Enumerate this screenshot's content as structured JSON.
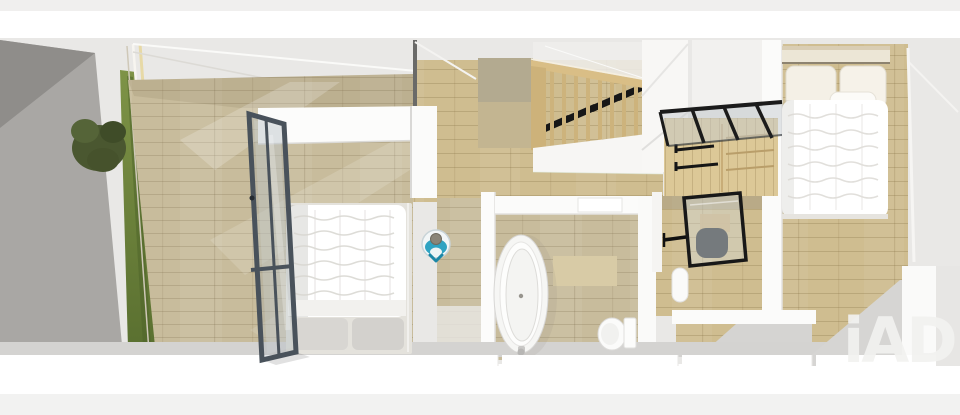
{
  "meta": {
    "width": 960,
    "height": 415,
    "view": "3d-floor-plan-top-view"
  },
  "watermark": {
    "text": "iAD"
  },
  "marker": {
    "icon": "person-top-view-icon"
  },
  "palette": {
    "background": "#ffffff",
    "upper_wall_zone": "#e9e8e6",
    "exterior_wall": "#a9a7a4",
    "exterior_wall_dark": "#8f8d8a",
    "interior_wall": "#fbfbfa",
    "wall_shadow": "#d5d4d2",
    "wood_light": "#c8bc9c",
    "wood_warm": "#cfbd90",
    "wood_pale": "#dcc897",
    "grass": "#7e9347",
    "grass_dark": "#5a7030",
    "tree": "#4a5730",
    "door_frame": "#49525b",
    "stair_wood": "#d9be86",
    "stair_tread": "#171717",
    "closet_frame": "#1b1b1b",
    "chair": "#3b3e41",
    "linen": "#ffffff",
    "pillow_gray": "#d8d6d2",
    "marker_accent": "#2fa3c2",
    "marker_arrow": "#1d87a6",
    "watermark_color": "#f2f2f0"
  }
}
